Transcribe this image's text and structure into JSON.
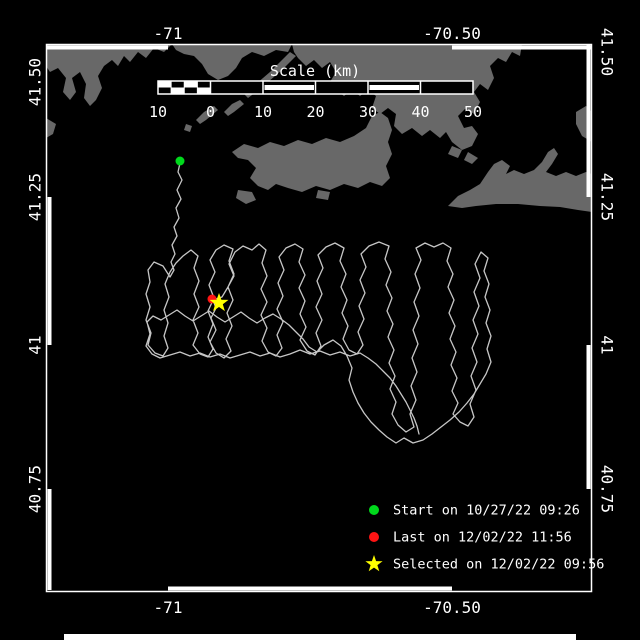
{
  "colors": {
    "background": "#000000",
    "frame": "#ffffff",
    "land": "#686868",
    "track": "#c6c6c6",
    "start_marker": "#00d91c",
    "last_marker": "#ff1414",
    "selected_marker": "#ffff00",
    "text": "#ffffff"
  },
  "frame": {
    "x1": 46,
    "y1": 44,
    "x2": 592,
    "y2": 592,
    "white_segments": {
      "top": [
        [
          47,
          168
        ],
        [
          452,
          592
        ]
      ],
      "bottom": [
        [
          168,
          452
        ]
      ],
      "left": [
        [
          197,
          345
        ],
        [
          489,
          590
        ]
      ],
      "right": [
        [
          44,
          197
        ],
        [
          345,
          489
        ]
      ]
    },
    "bottom_bar": {
      "x": 64,
      "y": 634,
      "w": 512,
      "h": 6
    }
  },
  "axis": {
    "top": [
      {
        "label": "-71",
        "x": 168
      },
      {
        "label": "-70.50",
        "x": 452
      }
    ],
    "bottom": [
      {
        "label": "-71",
        "x": 168
      },
      {
        "label": "-70.50",
        "x": 452
      }
    ],
    "left": [
      {
        "label": "41.50",
        "y": 82
      },
      {
        "label": "41.25",
        "y": 197
      },
      {
        "label": "41",
        "y": 345
      },
      {
        "label": "40.75",
        "y": 489
      }
    ],
    "right": [
      {
        "label": "41.50",
        "y": 52
      },
      {
        "label": "41.25",
        "y": 197
      },
      {
        "label": "41",
        "y": 345
      },
      {
        "label": "40.75",
        "y": 489
      }
    ]
  },
  "scalebar": {
    "title": "Scale (km)",
    "title_x": 315,
    "title_y": 76,
    "bar_y": 81,
    "bar_h": 13,
    "km0_x": 210.5,
    "px_per_km": 5.25,
    "km_min": -10,
    "km_max": 50,
    "ticks": [
      {
        "label": "10",
        "km": -10
      },
      {
        "label": "0",
        "km": 0
      },
      {
        "label": "10",
        "km": 10
      },
      {
        "label": "20",
        "km": 20
      },
      {
        "label": "30",
        "km": 30
      },
      {
        "label": "40",
        "km": 40
      },
      {
        "label": "50",
        "km": 50
      }
    ],
    "numbers_y": 117,
    "striped_segments": [
      [
        10,
        20
      ],
      [
        30,
        40
      ]
    ],
    "checker_cols": 4
  },
  "map": {
    "land_polygons": [
      [
        46,
        44,
        172,
        44,
        164,
        52,
        154,
        48,
        146,
        58,
        138,
        52,
        130,
        62,
        124,
        56,
        118,
        66,
        112,
        60,
        104,
        66,
        98,
        76,
        102,
        88,
        96,
        100,
        90,
        106,
        84,
        98,
        86,
        84,
        80,
        72,
        72,
        78,
        76,
        92,
        70,
        100,
        63,
        92,
        66,
        78,
        58,
        68,
        50,
        72,
        46,
        66
      ],
      [
        46,
        118,
        56,
        124,
        53,
        134,
        46,
        138
      ],
      [
        172,
        44,
        292,
        44,
        288,
        52,
        276,
        50,
        264,
        56,
        252,
        52,
        242,
        58,
        236,
        68,
        228,
        76,
        218,
        80,
        208,
        74,
        202,
        64,
        194,
        56,
        184,
        54,
        176,
        50
      ],
      [
        290,
        52,
        296,
        56,
        282,
        70,
        268,
        82,
        256,
        92,
        248,
        98,
        244,
        94,
        256,
        84,
        270,
        72,
        284,
        58
      ],
      [
        240,
        100,
        244,
        104,
        234,
        112,
        228,
        116,
        224,
        112,
        232,
        104
      ],
      [
        214,
        106,
        218,
        110,
        206,
        120,
        200,
        124,
        196,
        120,
        204,
        112
      ],
      [
        186,
        124,
        192,
        126,
        190,
        132,
        184,
        130
      ],
      [
        292,
        44,
        522,
        44,
        520,
        56,
        512,
        52,
        506,
        62,
        498,
        58,
        490,
        66,
        494,
        78,
        488,
        90,
        480,
        84,
        474,
        92,
        480,
        102,
        474,
        114,
        466,
        108,
        458,
        116,
        464,
        128,
        472,
        126,
        478,
        134,
        472,
        146,
        462,
        150,
        452,
        142,
        446,
        132,
        440,
        138,
        430,
        130,
        422,
        136,
        412,
        128,
        402,
        134,
        394,
        126,
        396,
        114,
        388,
        108,
        380,
        114,
        372,
        108,
        376,
        96,
        368,
        90,
        360,
        96,
        352,
        90,
        344,
        96,
        336,
        90,
        330,
        82,
        336,
        72,
        330,
        62,
        322,
        68,
        314,
        60,
        306,
        66,
        298,
        58,
        294,
        52
      ],
      [
        232,
        152,
        244,
        144,
        258,
        148,
        270,
        142,
        284,
        146,
        298,
        140,
        312,
        144,
        326,
        138,
        340,
        142,
        354,
        136,
        366,
        128,
        372,
        116,
        380,
        112,
        388,
        118,
        392,
        130,
        388,
        142,
        392,
        154,
        386,
        166,
        390,
        178,
        382,
        186,
        370,
        182,
        358,
        188,
        344,
        184,
        330,
        190,
        316,
        186,
        302,
        192,
        288,
        188,
        276,
        184,
        268,
        190,
        258,
        186,
        250,
        178,
        256,
        168,
        248,
        160,
        238,
        158
      ],
      [
        238,
        190,
        252,
        192,
        256,
        200,
        246,
        204,
        236,
        198
      ],
      [
        318,
        190,
        330,
        192,
        328,
        200,
        316,
        198
      ],
      [
        452,
        146,
        462,
        150,
        458,
        158,
        448,
        154
      ],
      [
        468,
        152,
        478,
        158,
        472,
        164,
        464,
        160
      ],
      [
        448,
        206,
        458,
        196,
        470,
        190,
        480,
        184,
        488,
        172,
        494,
        164,
        502,
        160,
        510,
        166,
        506,
        174,
        514,
        170,
        524,
        174,
        534,
        170,
        542,
        162,
        548,
        152,
        554,
        148,
        558,
        154,
        552,
        164,
        546,
        172,
        556,
        176,
        566,
        172,
        576,
        176,
        586,
        172,
        592,
        174,
        592,
        212,
        578,
        210,
        560,
        207,
        540,
        206,
        518,
        204,
        496,
        204,
        476,
        206,
        462,
        208
      ],
      [
        576,
        112,
        586,
        106,
        592,
        112,
        592,
        142,
        582,
        136,
        576,
        124
      ]
    ],
    "track_points": [
      180,
      163,
      178,
      172,
      182,
      180,
      177,
      190,
      181,
      199,
      176,
      208,
      179,
      218,
      174,
      227,
      177,
      236,
      172,
      245,
      175,
      254,
      171,
      262,
      174,
      270,
      170,
      277,
      163,
      266,
      154,
      262,
      148,
      270,
      150,
      282,
      146,
      294,
      150,
      307,
      146,
      320,
      151,
      333,
      148,
      345,
      155,
      353,
      163,
      356,
      168,
      348,
      164,
      336,
      168,
      323,
      164,
      310,
      169,
      297,
      165,
      284,
      170,
      272,
      176,
      263,
      183,
      256,
      191,
      250,
      198,
      256,
      194,
      268,
      199,
      281,
      194,
      294,
      199,
      307,
      193,
      320,
      198,
      333,
      193,
      345,
      200,
      354,
      208,
      357,
      213,
      349,
      208,
      337,
      213,
      324,
      208,
      311,
      214,
      298,
      209,
      285,
      215,
      272,
      210,
      260,
      216,
      250,
      224,
      245,
      233,
      249,
      229,
      261,
      234,
      274,
      228,
      287,
      222,
      297,
      213,
      300,
      216,
      308,
      211,
      318,
      216,
      330,
      210,
      342,
      216,
      353,
      224,
      358,
      231,
      351,
      226,
      339,
      232,
      326,
      227,
      313,
      233,
      300,
      228,
      287,
      234,
      276,
      229,
      264,
      235,
      252,
      243,
      246,
      252,
      250,
      259,
      244,
      266,
      250,
      262,
      263,
      267,
      276,
      261,
      289,
      267,
      302,
      261,
      315,
      267,
      328,
      262,
      341,
      268,
      352,
      276,
      356,
      282,
      348,
      277,
      335,
      283,
      322,
      277,
      309,
      283,
      296,
      278,
      283,
      284,
      270,
      279,
      257,
      286,
      248,
      295,
      244,
      303,
      249,
      299,
      262,
      305,
      275,
      299,
      288,
      305,
      301,
      300,
      314,
      306,
      327,
      300,
      340,
      307,
      351,
      315,
      355,
      321,
      346,
      316,
      333,
      322,
      320,
      316,
      307,
      322,
      294,
      317,
      281,
      323,
      268,
      318,
      255,
      326,
      247,
      335,
      243,
      344,
      248,
      340,
      261,
      346,
      274,
      341,
      287,
      347,
      300,
      342,
      313,
      348,
      326,
      343,
      339,
      349,
      350,
      357,
      354,
      363,
      345,
      358,
      332,
      364,
      319,
      359,
      306,
      365,
      293,
      360,
      280,
      366,
      267,
      361,
      254,
      369,
      246,
      379,
      242,
      389,
      246,
      385,
      259,
      391,
      272,
      386,
      285,
      392,
      298,
      387,
      311,
      393,
      324,
      388,
      337,
      394,
      350,
      389,
      363,
      395,
      376,
      390,
      389,
      396,
      402,
      392,
      414,
      398,
      425,
      406,
      432,
      414,
      427,
      410,
      414,
      416,
      400,
      411,
      386,
      417,
      372,
      412,
      358,
      418,
      344,
      413,
      330,
      419,
      316,
      414,
      302,
      420,
      288,
      415,
      274,
      421,
      260,
      416,
      248,
      425,
      243,
      434,
      247,
      443,
      243,
      451,
      248,
      447,
      261,
      453,
      274,
      448,
      287,
      454,
      300,
      449,
      313,
      455,
      326,
      450,
      339,
      456,
      352,
      451,
      365,
      457,
      378,
      452,
      391,
      458,
      403,
      453,
      414,
      460,
      422,
      468,
      426,
      474,
      417,
      470,
      404,
      476,
      390,
      471,
      376,
      477,
      362,
      472,
      348,
      478,
      334,
      473,
      320,
      479,
      306,
      474,
      292,
      480,
      278,
      475,
      264,
      481,
      252,
      488,
      258,
      484,
      271,
      489,
      284,
      485,
      297,
      490,
      310,
      486,
      323,
      491,
      336,
      487,
      349,
      491,
      362,
      486,
      374,
      480,
      384,
      474,
      394,
      467,
      403,
      459,
      412,
      450,
      420,
      441,
      427,
      432,
      434,
      423,
      440,
      413,
      443,
      404,
      438,
      396,
      443,
      387,
      437,
      379,
      430,
      371,
      422,
      364,
      413,
      358,
      403,
      353,
      392,
      349,
      380,
      352,
      368,
      347,
      356,
      341,
      346,
      333,
      340,
      324,
      345,
      317,
      352,
      309,
      347,
      303,
      339,
      296,
      332,
      289,
      325,
      281,
      319,
      273,
      314,
      265,
      318,
      257,
      323,
      249,
      318,
      241,
      312,
      233,
      317,
      225,
      322,
      217,
      317,
      209,
      311,
      201,
      316,
      193,
      321,
      185,
      316,
      177,
      310,
      169,
      315,
      161,
      320,
      153,
      316,
      147,
      322,
      150,
      334,
      146,
      346,
      152,
      354,
      160,
      358,
      170,
      355,
      180,
      352,
      190,
      356,
      200,
      353,
      210,
      357,
      220,
      354,
      230,
      358,
      240,
      355,
      250,
      352,
      260,
      356,
      270,
      353,
      280,
      357,
      290,
      354,
      300,
      350,
      310,
      354,
      320,
      351,
      330,
      355,
      340,
      352,
      350,
      356,
      360,
      353,
      368,
      358,
      376,
      364,
      383,
      371,
      390,
      378,
      396,
      386,
      401,
      394,
      406,
      402,
      410,
      410,
      414,
      418,
      417,
      426,
      419,
      434
    ],
    "markers": {
      "start": {
        "x": 180,
        "y": 161,
        "r": 4.5
      },
      "last": {
        "x": 212,
        "y": 299,
        "r": 4.5
      },
      "selected": {
        "x": 219,
        "y": 303,
        "outer_r": 10,
        "inner_r": 4
      }
    }
  },
  "legend": {
    "marker_x": 374,
    "text_x": 393,
    "row_ys": [
      510,
      537,
      564
    ],
    "dot_r": 5,
    "star_outer_r": 9,
    "star_inner_r": 3.6,
    "items": [
      {
        "shape": "circle",
        "color": "#00d91c",
        "label": "Start on 10/27/22 09:26"
      },
      {
        "shape": "circle",
        "color": "#ff1414",
        "label": "Last on 12/02/22 11:56"
      },
      {
        "shape": "star",
        "color": "#ffff00",
        "label": "Selected on 12/02/22 09:56"
      }
    ]
  }
}
